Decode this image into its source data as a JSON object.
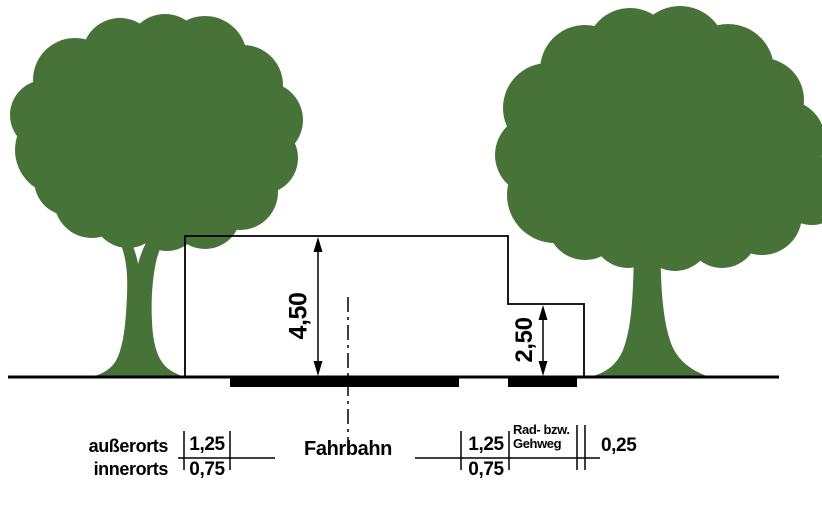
{
  "diagram": {
    "clearance_over_road": "4,50",
    "clearance_over_path": "2,50",
    "left_margin": {
      "label_top": "außerorts",
      "label_bottom": "innerorts",
      "value_top": "1,25",
      "value_bottom": "0,75"
    },
    "road_label": "Fahrbahn",
    "right_margin": {
      "value_top": "1,25",
      "value_bottom": "0,75"
    },
    "path_label_line1": "Rad- bzw.",
    "path_label_line2": "Gehweg",
    "edge_offset": "0,25"
  },
  "colors": {
    "tree": "#477338",
    "line": "#000000",
    "bar": "#000000",
    "background": "#ffffff"
  }
}
